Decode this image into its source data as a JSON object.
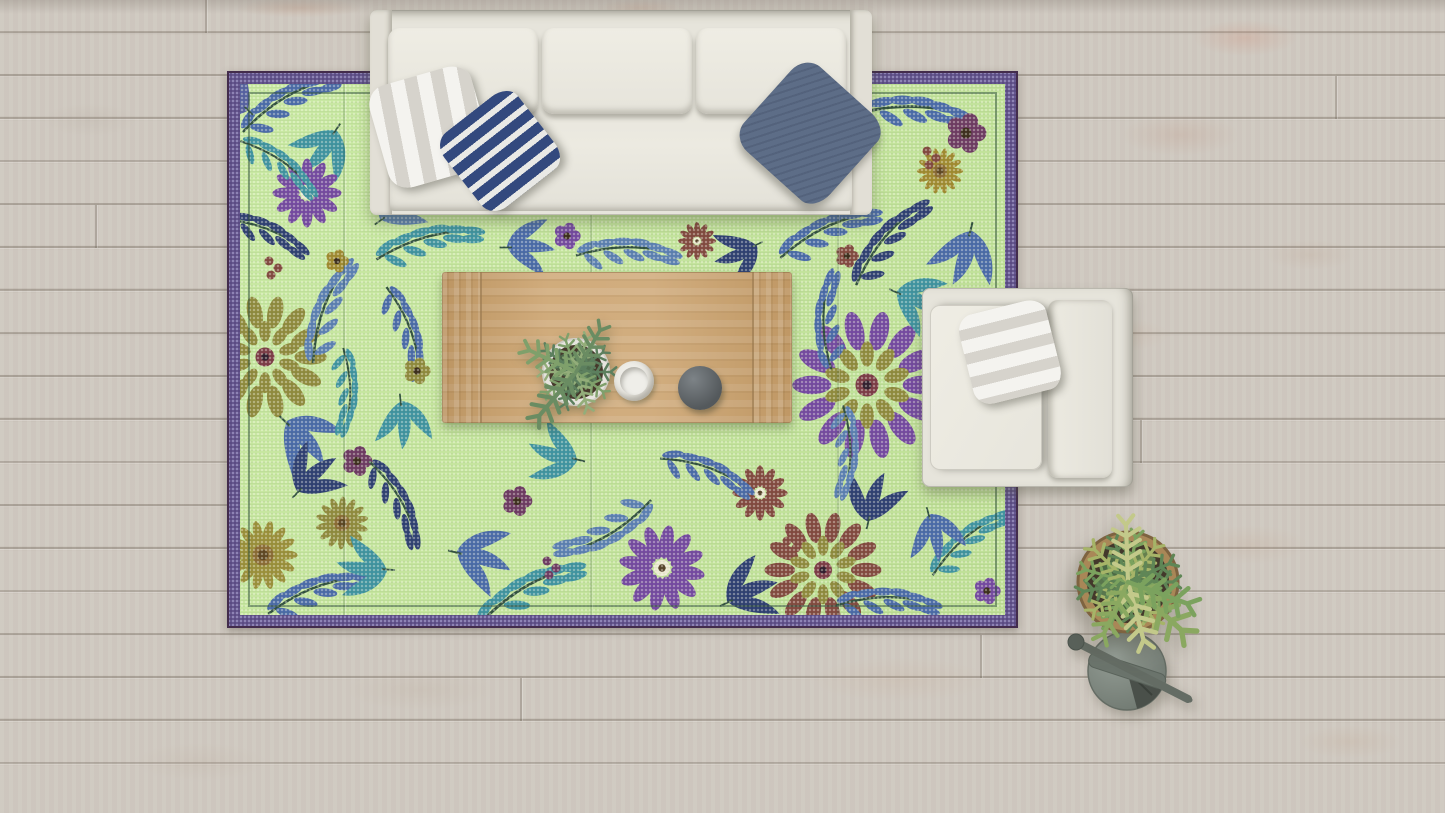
{
  "scene": {
    "title": "Top-down living room with green floral rug",
    "description": "Bird's-eye 3D render: cream three-seat sofa with striped pillows, green floral plastic rug with purple border, light-wood coffee table holding a potted plant, white bowl and dark sphere, cream armchair with striped pillow, and a potted plant with grey watering can on a whitewashed wood plank floor",
    "objects": [
      {
        "name": "wood-floor",
        "label": "whitewashed wood plank floor",
        "color": "#cdc6bd"
      },
      {
        "name": "area-rug",
        "label": "green floral mat rug with purple dotted border",
        "field_color": "#c3e49c",
        "border_color": "#5a4b83"
      },
      {
        "name": "sofa",
        "label": "cream three-seat sofa",
        "color": "#e6e4db"
      },
      {
        "name": "pillow-white-striped",
        "label": "white and grey striped pillow",
        "colors": [
          "#f4f3ef",
          "#d6d3cc"
        ]
      },
      {
        "name": "pillow-navy-striped",
        "label": "navy and white striped pillow",
        "colors": [
          "#33497e",
          "#e9e9e6"
        ]
      },
      {
        "name": "pillow-slate",
        "label": "slate blue pillow",
        "color": "#5d6d87"
      },
      {
        "name": "coffee-table",
        "label": "light oak coffee table",
        "color": "#cba26d"
      },
      {
        "name": "potted-plant-table",
        "label": "small potted plant in white pot",
        "colors": [
          "#5c7f5e",
          "#e7e5df"
        ]
      },
      {
        "name": "white-bowl",
        "label": "white bowl",
        "color": "#efeee9"
      },
      {
        "name": "dark-bowl",
        "label": "dark grey sphere bowl",
        "color": "#54595c"
      },
      {
        "name": "armchair",
        "label": "cream armchair",
        "color": "#e6e4db"
      },
      {
        "name": "pillow-chair-striped",
        "label": "white and grey striped pillow on armchair",
        "colors": [
          "#f4f3ef",
          "#d8d6d0"
        ]
      },
      {
        "name": "potted-plant-floor",
        "label": "bushy potted plant in tan pot",
        "colors": [
          "#5f8656",
          "#a6b468",
          "#a98757"
        ]
      },
      {
        "name": "watering-can",
        "label": "grey watering can with long spout",
        "color": "#7c857e"
      }
    ]
  },
  "palette": {
    "floor-base": "#cdc6bd",
    "floor-seam": "#9d948b",
    "rug-field": "#c3e49c",
    "rug-border": "#5a4b83",
    "rug-border-dot": "#9187b8",
    "rug-inner-line": "#3f5c49",
    "sofa-body": "#e6e4db",
    "sofa-cushion": "#edebe2",
    "pillow-white": "#f4f3ef",
    "pillow-gray": "#d6d3cc",
    "pillow-navy": "#33497e",
    "pillow-slate": "#5d6d87",
    "table-wood": "#cba26d",
    "cup-white": "#efeee9",
    "bowl-dark": "#54595c",
    "pot-terracotta": "#a98757",
    "soil-dark": "#43382b",
    "plant-green": "#5f8656",
    "plant-light": "#a6b468",
    "can-gray": "#7c857e"
  },
  "rug": {
    "motifs": [
      {
        "type": "branch",
        "x": 47,
        "y": 17,
        "rot": -20,
        "s": 1,
        "color": "#4a6aa8"
      },
      {
        "type": "frond",
        "x": 97,
        "y": 47,
        "rot": 140,
        "s": 0.9,
        "color": "#3f93a0"
      },
      {
        "type": "daisy",
        "x": 67,
        "y": 109,
        "rot": 0,
        "s": 1,
        "color": "#7449a0"
      },
      {
        "type": "branch",
        "x": 22,
        "y": 147,
        "rot": 30,
        "s": 0.9,
        "color": "#2e3f72"
      },
      {
        "type": "berries",
        "x": 29,
        "y": 177,
        "rot": 0,
        "s": 1,
        "color": "#82493f"
      },
      {
        "type": "mandala",
        "x": 25,
        "y": 273,
        "rot": 0,
        "s": 0.95,
        "color": "#8f8a3d"
      },
      {
        "type": "branch",
        "x": 87,
        "y": 227,
        "rot": -60,
        "s": 1,
        "color": "#5b7fb2"
      },
      {
        "type": "frond",
        "x": 47,
        "y": 337,
        "rot": 60,
        "s": 1,
        "color": "#4a6aa8"
      },
      {
        "type": "branch",
        "x": 107,
        "y": 307,
        "rot": 100,
        "s": 0.8,
        "color": "#3f93a0"
      },
      {
        "type": "sunflower",
        "x": 23,
        "y": 471,
        "rot": 0,
        "s": 1.05,
        "color": "#9a8f3a"
      },
      {
        "type": "sunflower",
        "x": 102,
        "y": 439,
        "rot": 15,
        "s": 0.8,
        "color": "#8f8a3d"
      },
      {
        "type": "frond",
        "x": 57,
        "y": 407,
        "rot": -30,
        "s": 0.9,
        "color": "#2e3f72"
      },
      {
        "type": "flower5",
        "x": 117,
        "y": 377,
        "rot": 0,
        "s": 0.9,
        "color": "#6d3a62"
      },
      {
        "type": "branch",
        "x": 77,
        "y": 507,
        "rot": -10,
        "s": 1,
        "color": "#4a6aa8"
      },
      {
        "type": "frond",
        "x": 147,
        "y": 487,
        "rot": 200,
        "s": 0.9,
        "color": "#3f93a0"
      },
      {
        "type": "branch",
        "x": 667,
        "y": 27,
        "rot": 10,
        "s": 1.1,
        "color": "#4a6aa8"
      },
      {
        "type": "flower5",
        "x": 726,
        "y": 49,
        "rot": 0,
        "s": 1.2,
        "color": "#6d3a62"
      },
      {
        "type": "sunflower",
        "x": 700,
        "y": 87,
        "rot": 0,
        "s": 0.7,
        "color": "#a08a30"
      },
      {
        "type": "branch",
        "x": 647,
        "y": 157,
        "rot": -40,
        "s": 1,
        "color": "#2e3f72"
      },
      {
        "type": "frond",
        "x": 732,
        "y": 147,
        "rot": 120,
        "s": 1,
        "color": "#4a6aa8"
      },
      {
        "type": "berries",
        "x": 687,
        "y": 67,
        "rot": 0,
        "s": 1,
        "color": "#82493f"
      },
      {
        "type": "branch",
        "x": 187,
        "y": 157,
        "rot": -5,
        "s": 1,
        "color": "#3f93a0"
      },
      {
        "type": "frond",
        "x": 267,
        "y": 162,
        "rot": 15,
        "s": 0.85,
        "color": "#4a6aa8"
      },
      {
        "type": "flower5",
        "x": 327,
        "y": 152,
        "rot": 0,
        "s": 0.8,
        "color": "#7449a0"
      },
      {
        "type": "branch",
        "x": 387,
        "y": 167,
        "rot": 10,
        "s": 0.95,
        "color": "#5b7fb2"
      },
      {
        "type": "daisy",
        "x": 457,
        "y": 157,
        "rot": 0,
        "s": 0.55,
        "color": "#82493f"
      },
      {
        "type": "frond",
        "x": 517,
        "y": 162,
        "rot": 170,
        "s": 0.8,
        "color": "#2e3f72"
      },
      {
        "type": "branch",
        "x": 587,
        "y": 147,
        "rot": -15,
        "s": 1,
        "color": "#4a6aa8"
      },
      {
        "type": "flower5",
        "x": 607,
        "y": 172,
        "rot": 0,
        "s": 0.7,
        "color": "#82493f"
      },
      {
        "type": "branch",
        "x": 167,
        "y": 247,
        "rot": 80,
        "s": 0.9,
        "color": "#4a6aa8"
      },
      {
        "type": "frond",
        "x": 162,
        "y": 317,
        "rot": 100,
        "s": 0.85,
        "color": "#3f93a0"
      },
      {
        "type": "flower5",
        "x": 177,
        "y": 287,
        "rot": 0,
        "s": 0.8,
        "color": "#8f8a3d"
      },
      {
        "type": "branch",
        "x": 157,
        "y": 417,
        "rot": 70,
        "s": 0.9,
        "color": "#2e3f72"
      },
      {
        "type": "frond",
        "x": 217,
        "y": 467,
        "rot": 30,
        "s": 1,
        "color": "#4a6aa8"
      },
      {
        "type": "branch",
        "x": 287,
        "y": 507,
        "rot": -20,
        "s": 1.1,
        "color": "#3f93a0"
      },
      {
        "type": "daisy",
        "x": 422,
        "y": 484,
        "rot": 10,
        "s": 1.25,
        "color": "#7449a0"
      },
      {
        "type": "branch",
        "x": 367,
        "y": 447,
        "rot": 160,
        "s": 1,
        "color": "#5b7fb2"
      },
      {
        "type": "frond",
        "x": 487,
        "y": 517,
        "rot": -10,
        "s": 0.95,
        "color": "#2e3f72"
      },
      {
        "type": "daisy",
        "x": 520,
        "y": 409,
        "rot": 0,
        "s": 0.8,
        "color": "#82493f"
      },
      {
        "type": "branch",
        "x": 467,
        "y": 387,
        "rot": 30,
        "s": 0.9,
        "color": "#4a6aa8"
      },
      {
        "type": "frond",
        "x": 337,
        "y": 377,
        "rot": -150,
        "s": 0.9,
        "color": "#3f93a0"
      },
      {
        "type": "flower5",
        "x": 277,
        "y": 417,
        "rot": 0,
        "s": 0.9,
        "color": "#6d3a62"
      },
      {
        "type": "berries",
        "x": 547,
        "y": 457,
        "rot": 0,
        "s": 1,
        "color": "#82493f"
      },
      {
        "type": "mandala",
        "x": 583,
        "y": 486,
        "rot": 0,
        "s": 0.9,
        "color": "#82493f"
      },
      {
        "type": "branch",
        "x": 647,
        "y": 517,
        "rot": 10,
        "s": 0.95,
        "color": "#4a6aa8"
      },
      {
        "type": "frond",
        "x": 627,
        "y": 437,
        "rot": -60,
        "s": 0.9,
        "color": "#2e3f72"
      },
      {
        "type": "mandala",
        "x": 627,
        "y": 301,
        "rot": 0,
        "s": 1.15,
        "color": "#7449a0"
      },
      {
        "type": "branch",
        "x": 587,
        "y": 237,
        "rot": -80,
        "s": 0.9,
        "color": "#4a6aa8"
      },
      {
        "type": "frond",
        "x": 657,
        "y": 207,
        "rot": 40,
        "s": 0.9,
        "color": "#3f93a0"
      },
      {
        "type": "branch",
        "x": 607,
        "y": 367,
        "rot": 100,
        "s": 0.85,
        "color": "#5b7fb2"
      },
      {
        "type": "branch",
        "x": 727,
        "y": 457,
        "rot": -30,
        "s": 0.9,
        "color": "#3f93a0"
      },
      {
        "type": "flower5",
        "x": 747,
        "y": 507,
        "rot": 0,
        "s": 0.8,
        "color": "#7449a0"
      },
      {
        "type": "frond",
        "x": 7,
        "y": 27,
        "rot": -120,
        "s": 0.8,
        "color": "#5560a0"
      },
      {
        "type": "frond",
        "x": 140,
        "y": 135,
        "rot": -20,
        "s": 0.85,
        "color": "#5b7fb2"
      },
      {
        "type": "branch",
        "x": 40,
        "y": 80,
        "rot": 45,
        "s": 0.85,
        "color": "#3f93a0"
      },
      {
        "type": "flower5",
        "x": 97,
        "y": 177,
        "rot": 0,
        "s": 0.7,
        "color": "#a08a30"
      },
      {
        "type": "berries",
        "x": 307,
        "y": 477,
        "rot": 0,
        "s": 1,
        "color": "#6d3a62"
      },
      {
        "type": "frond",
        "x": 690,
        "y": 430,
        "rot": 90,
        "s": 0.85,
        "color": "#4a6aa8"
      }
    ]
  }
}
